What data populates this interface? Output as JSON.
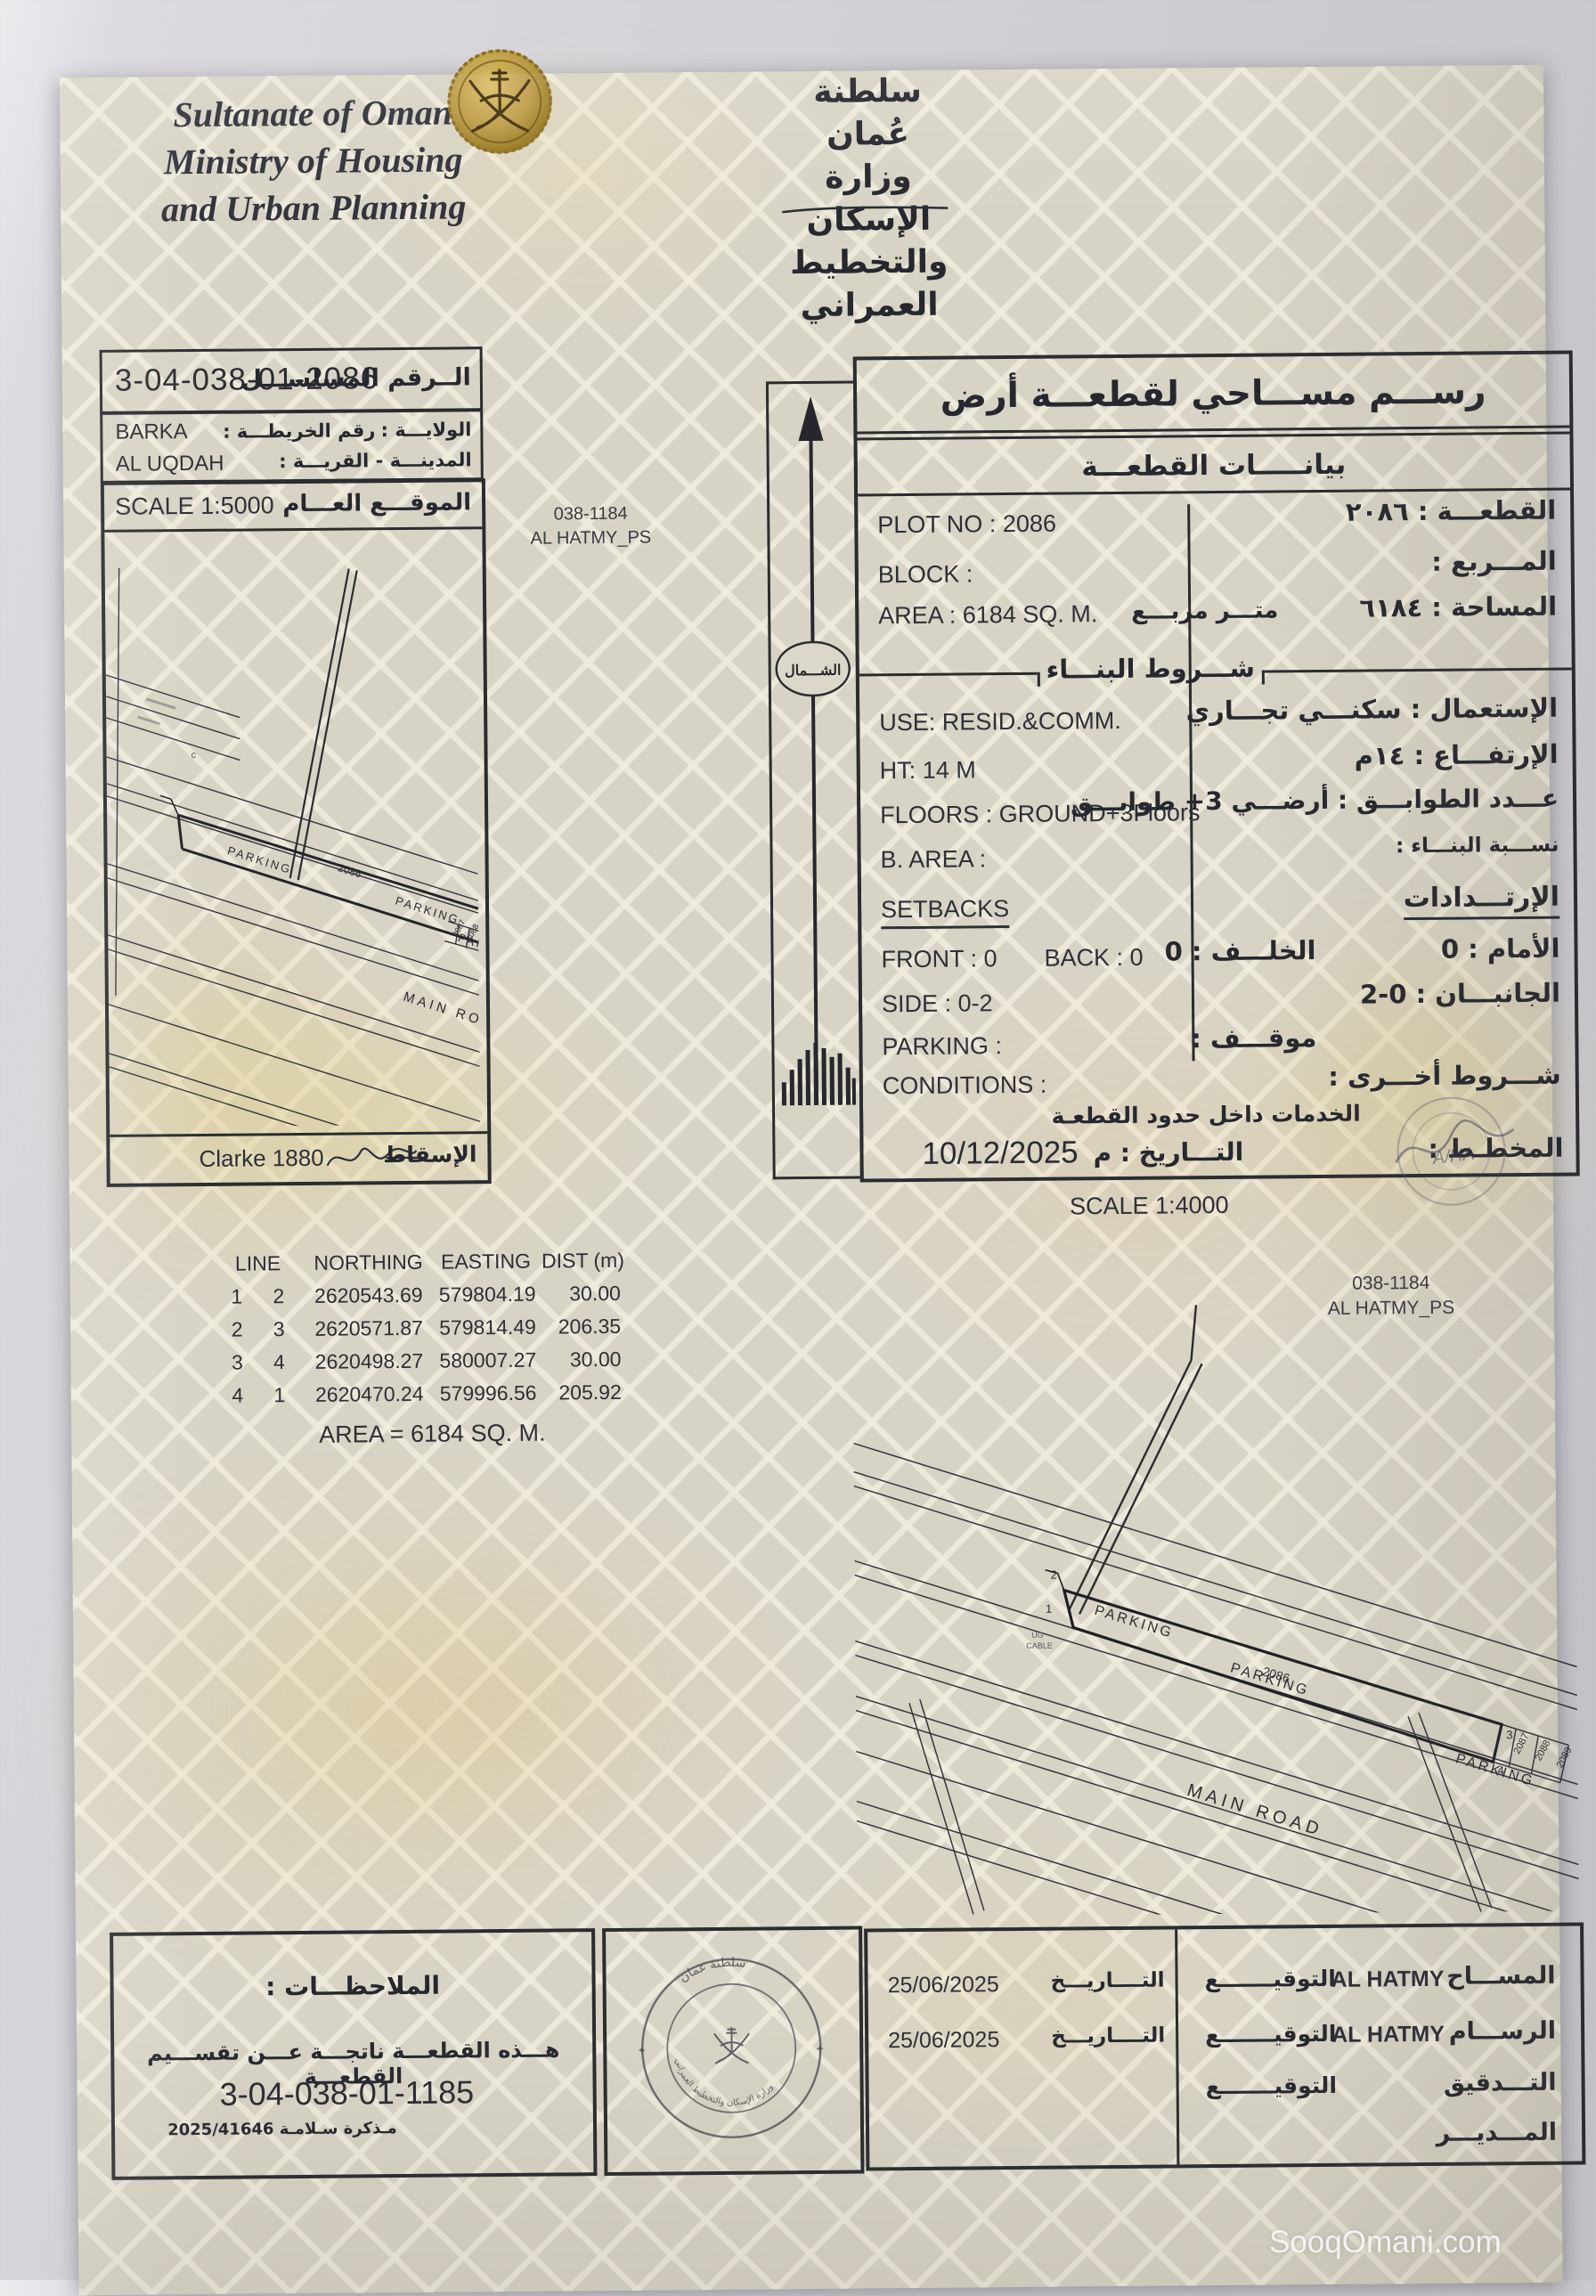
{
  "page": {
    "watermark": "SooqOmani.com"
  },
  "header": {
    "en_line1": "Sultanate of Oman",
    "en_line2": "Ministry of Housing",
    "en_line3": "and Urban Planning",
    "ar_line1": "سلطنة عُمان",
    "ar_line2": "وزارة الإسكان",
    "ar_line3": "والتخطيط العمراني"
  },
  "serial": {
    "value": "3-04-038-01-2086",
    "label_ar": "الــرقم المسلســـل"
  },
  "location": {
    "map_no_label": "رقم الخريطـــة :",
    "wilaya_label": "الولايـــة :",
    "wilaya_value": "BARKA",
    "village_label": "المدينـــة - القريـــة :",
    "village_value": "AL UQDAH"
  },
  "plan1": {
    "scale": "SCALE 1:5000",
    "title_ar": "الموقـــع العـــام",
    "area_code": "038-1184",
    "area_name": "AL HATMY_PS",
    "parking": "PARKING",
    "main_road": "MAIN ROAD",
    "plot_no": "2086",
    "adj1": "2087",
    "adj2": "2088",
    "marker": "c",
    "datum": "Clarke 1880",
    "projection_label": "الإسقاط"
  },
  "north": {
    "label": "الشـــمال"
  },
  "survey": {
    "title": "رســـم مســـاحي لقطعـــة أرض",
    "subtitle": "بيانـــــات القطعـــة",
    "plot_no_en": "PLOT NO :  2086",
    "plot_ar": "القطعـــة :  ٢٠٨٦",
    "block_en": "BLOCK :",
    "block_ar": "المـــربع :",
    "area_en": "AREA :  6184 SQ. M.",
    "area_unit_ar": "متـــر مربـــع",
    "area_ar": "المساحة :  ٦١٨٤",
    "conditions_header": "شـــروط البنـــاء",
    "use_en": "USE:  RESID.&COMM.",
    "use_ar": "الإستعمال :  سكنـــي تجـــاري",
    "ht_en": "HT:  14 M",
    "ht_ar": "الإرتفـــاع :  ١٤م",
    "floors_en": "FLOORS : GROUND+3Floors",
    "floors_ar": "عـــدد الطوابـــق :  أرضـــي ‎+3‎ طوابـــق",
    "barea_en": "B. AREA :",
    "barea_ar": "نســـبة البنـــاء :",
    "setbacks_en": "SETBACKS",
    "setbacks_ar": "الإرتـــدادات",
    "front_en": "FRONT : 0",
    "back_en": "BACK : 0",
    "back_ar": "الخلـــف :  0",
    "front_ar": "الأمام :   0",
    "side_en": "SIDE :  0-2",
    "side_ar": "الجانبـــان : 0-2",
    "parking_en": "PARKING :",
    "parking_ar": "موقـــف :",
    "conditions_en": "CONDITIONS :",
    "conditions_ar": "شـــروط أخـــرى :",
    "services_ar": "الخدمات  داخل حدود القطعـة",
    "date_label": "التـــاريخ : م",
    "date_value": "10/12/2025",
    "planner_label": "المخطـط :",
    "planner_sig": "A/HA"
  },
  "plan2": {
    "scale": "SCALE 1:4000",
    "area_code": "038-1184",
    "area_name": "AL HATMY_PS",
    "parking": "PARKING",
    "main_road": "MAIN ROAD",
    "plot_no": "2086",
    "adj1": "2087",
    "adj2": "2088",
    "adj3": "2089",
    "c1": "1",
    "c2": "2",
    "c3": "3",
    "c4": "4",
    "cable1": "UG",
    "cable2": "CABLE"
  },
  "coords": {
    "headers": [
      "LINE",
      "NORTHING",
      "EASTING",
      "DIST (m)"
    ],
    "rows": [
      [
        "1",
        "2",
        "2620543.69",
        "579804.19",
        "30.00"
      ],
      [
        "2",
        "3",
        "2620571.87",
        "579814.49",
        "206.35"
      ],
      [
        "3",
        "4",
        "2620498.27",
        "580007.27",
        "30.00"
      ],
      [
        "4",
        "1",
        "2620470.24",
        "579996.56",
        "205.92"
      ]
    ],
    "area_line": "AREA = 6184 SQ. M."
  },
  "notes": {
    "title": "الملاحظـــات :",
    "line1": "هـــذه القطعـــة ناتجـــة عـــن تقســـيم القطعـــة",
    "line2": "3-04-038-01-1185",
    "line3": "مـذكرة سـلامـة  2025/41646"
  },
  "stamp": {
    "top": "سلطنة عمان",
    "bottom": "وزارة الإسكان والتخطيط العمراني"
  },
  "signatures": {
    "rows": [
      {
        "role": "المســـاح",
        "name": "AL HATMY",
        "sig_label": "التوقيـــــــع",
        "date_label": "التــــاريـــخ",
        "date": "25/06/2025"
      },
      {
        "role": "الرســـام",
        "name": "AL HATMY",
        "sig_label": "التوقيـــــــع",
        "date_label": "التــــاريـــخ",
        "date": "25/06/2025"
      },
      {
        "role": "التـــدقيق",
        "name": "",
        "sig_label": "التوقيـــــــع",
        "date_label": "",
        "date": ""
      },
      {
        "role": "المـــديـــر",
        "name": "",
        "sig_label": "",
        "date_label": "",
        "date": ""
      }
    ]
  }
}
